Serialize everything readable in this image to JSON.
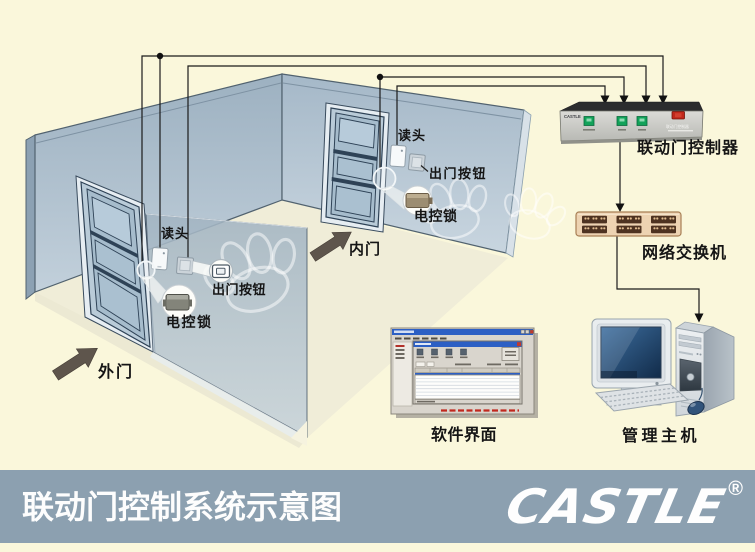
{
  "banner": {
    "title": "联动门控制系统示意图",
    "brand": "CASTLE",
    "registered": "®"
  },
  "labels": {
    "outer_door": "外门",
    "inner_door": "内门",
    "reader_outer": "读头",
    "reader_inner": "读头",
    "exit_button_outer": "出门按钮",
    "exit_button_inner": "出门按钮",
    "lock_outer": "电控锁",
    "lock_inner": "电控锁"
  },
  "devices": {
    "controller": {
      "label": "联动门控制器",
      "brand": "CASTLE",
      "panel_text": "联动门控制器"
    },
    "network_switch": {
      "label": "网络交换机"
    },
    "software_ui": {
      "label": "软件界面"
    },
    "management_host": {
      "label": "管理主机"
    }
  },
  "colors": {
    "background": "#FAF7DB",
    "banner": "#8CA0B0",
    "wall": "#AEC0CE",
    "button_green": "#12A259",
    "switch_red": "#C1271B"
  }
}
